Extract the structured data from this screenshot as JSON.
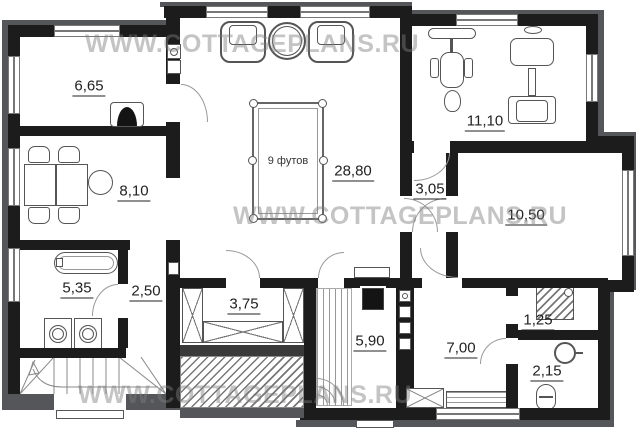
{
  "watermark": {
    "text": "WWW.COTTAGEPLANS.RU"
  },
  "rooms": {
    "living": {
      "area": "6,65"
    },
    "dining": {
      "area": "8,10"
    },
    "bathroom": {
      "area": "5,35"
    },
    "hallway": {
      "area": "2,50"
    },
    "wardrobe": {
      "area": "3,75"
    },
    "billiard_hall": {
      "area": "28,80"
    },
    "gym": {
      "area": "11,10"
    },
    "corridor": {
      "area": "3,05"
    },
    "bedroom": {
      "area": "10,50"
    },
    "sauna": {
      "area": "5,90"
    },
    "rest_room": {
      "area": "7,00"
    },
    "shower": {
      "area": "1,25"
    },
    "wc": {
      "area": "2,15"
    }
  },
  "billiard_table": {
    "label": "9 футов"
  },
  "furniture": [
    "fireplace",
    "dining-table",
    "chairs",
    "armchairs",
    "coffee-table",
    "billiard-table",
    "exercise-bike",
    "weight-machine",
    "bathtub",
    "washing-machines",
    "wardrobe-sections",
    "stairs",
    "sauna-bench",
    "sauna-stove",
    "chimney",
    "shower-tray",
    "sink",
    "toilet",
    "bench"
  ],
  "colors": {
    "wall": "#1c1c1c",
    "outer_wall": "#55565a",
    "label": "#222222",
    "watermark": "#7d7d7d"
  }
}
